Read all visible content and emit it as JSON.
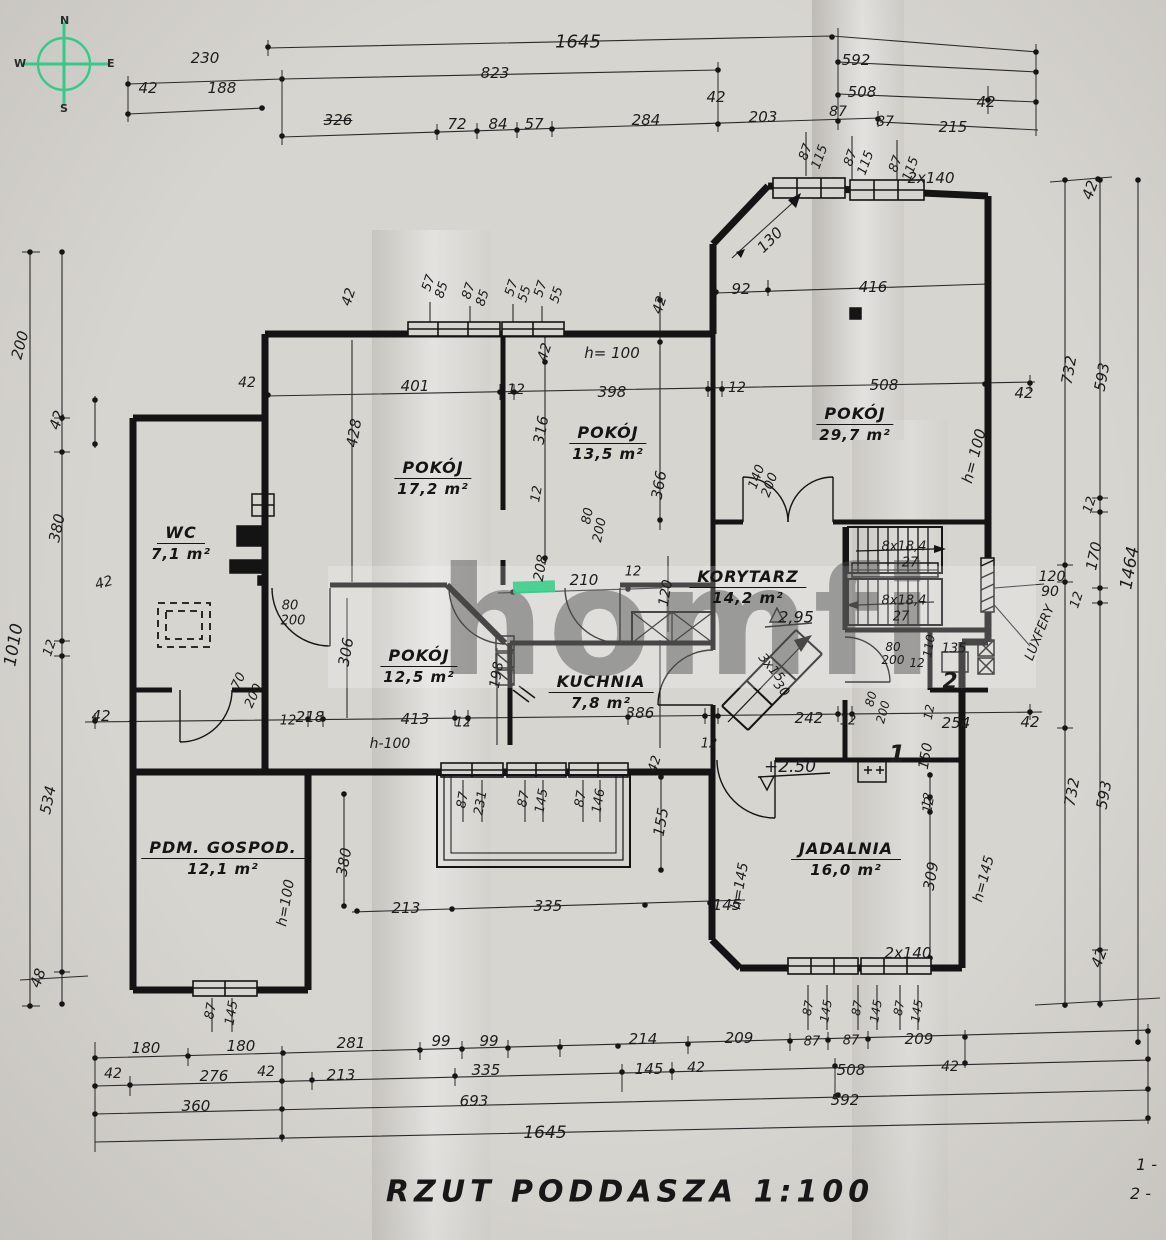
{
  "meta": {
    "title": "RZUT  PODDASZA  1:100"
  },
  "compass": {
    "n": "N",
    "e": "E",
    "s": "S",
    "w": "W"
  },
  "watermark": {
    "text": "homfi",
    "accent_color": "#3ecf8e"
  },
  "legend": {
    "items": [
      "1 -",
      "2 -"
    ]
  },
  "rooms": [
    {
      "name": "WC",
      "area": "7,1 m²",
      "x": 181,
      "y": 543
    },
    {
      "name": "POKÓJ",
      "area": "17,2 m²",
      "x": 433,
      "y": 478
    },
    {
      "name": "POKÓJ",
      "area": "13,5 m²",
      "x": 608,
      "y": 443
    },
    {
      "name": "POKÓJ",
      "area": "29,7 m²",
      "x": 855,
      "y": 424
    },
    {
      "name": "POKÓJ",
      "area": "12,5 m²",
      "x": 419,
      "y": 666
    },
    {
      "name": "KUCHNIA",
      "area": "7,8 m²",
      "x": 601,
      "y": 692
    },
    {
      "name": "KORYTARZ",
      "area": "14,2 m²",
      "x": 748,
      "y": 587
    },
    {
      "name": "PDM. GOSPOD.",
      "area": "12,1 m²",
      "x": 223,
      "y": 858
    },
    {
      "name": "JADALNIA",
      "area": "16,0 m²",
      "x": 846,
      "y": 859
    }
  ],
  "annotations": [
    {
      "t": "230",
      "x": 205,
      "y": 58
    },
    {
      "t": "42",
      "x": 148,
      "y": 88
    },
    {
      "t": "188",
      "x": 222,
      "y": 88
    },
    {
      "t": "326",
      "x": 338,
      "y": 120,
      "k": "strike"
    },
    {
      "t": "1645",
      "x": 578,
      "y": 42,
      "s": 18
    },
    {
      "t": "823",
      "x": 495,
      "y": 73
    },
    {
      "t": "42",
      "x": 716,
      "y": 97
    },
    {
      "t": "72",
      "x": 457,
      "y": 124
    },
    {
      "t": "84",
      "x": 498,
      "y": 124
    },
    {
      "t": "57",
      "x": 534,
      "y": 124
    },
    {
      "t": "284",
      "x": 646,
      "y": 120
    },
    {
      "t": "203",
      "x": 763,
      "y": 117
    },
    {
      "t": "592",
      "x": 856,
      "y": 60
    },
    {
      "t": "508",
      "x": 862,
      "y": 92
    },
    {
      "t": "42",
      "x": 986,
      "y": 102
    },
    {
      "t": "87",
      "x": 838,
      "y": 112,
      "s": 14
    },
    {
      "t": "87",
      "x": 885,
      "y": 122,
      "s": 14
    },
    {
      "t": "215",
      "x": 953,
      "y": 127
    },
    {
      "t": "42",
      "x": 1090,
      "y": 190,
      "r": -70
    },
    {
      "t": "87",
      "x": 806,
      "y": 152,
      "r": -70,
      "s": 13
    },
    {
      "t": "115",
      "x": 820,
      "y": 157,
      "r": -70,
      "s": 13
    },
    {
      "t": "87",
      "x": 851,
      "y": 158,
      "r": -70,
      "s": 13
    },
    {
      "t": "115",
      "x": 866,
      "y": 163,
      "r": -70,
      "s": 13
    },
    {
      "t": "87",
      "x": 896,
      "y": 164,
      "r": -70,
      "s": 13
    },
    {
      "t": "115",
      "x": 911,
      "y": 169,
      "r": -70,
      "s": 13
    },
    {
      "t": "2x140",
      "x": 931,
      "y": 178,
      "s": 15
    },
    {
      "t": "200",
      "x": 20,
      "y": 345,
      "r": -75
    },
    {
      "t": "42",
      "x": 57,
      "y": 420,
      "r": -72
    },
    {
      "t": "380",
      "x": 57,
      "y": 528,
      "r": -78
    },
    {
      "t": "1010",
      "x": 14,
      "y": 645,
      "r": -80,
      "s": 17
    },
    {
      "t": "12",
      "x": 50,
      "y": 648,
      "r": -72,
      "s": 13
    },
    {
      "t": "534",
      "x": 48,
      "y": 800,
      "r": -78
    },
    {
      "t": "48",
      "x": 38,
      "y": 978,
      "r": -70
    },
    {
      "t": "42",
      "x": 104,
      "y": 583,
      "r": -15,
      "s": 14
    },
    {
      "t": "42",
      "x": 101,
      "y": 716,
      "s": 15
    },
    {
      "t": "42",
      "x": 247,
      "y": 383,
      "s": 14
    },
    {
      "t": "42",
      "x": 349,
      "y": 297,
      "r": -72,
      "s": 14
    },
    {
      "t": "57",
      "x": 429,
      "y": 283,
      "r": -72,
      "s": 13
    },
    {
      "t": "85",
      "x": 442,
      "y": 290,
      "r": -72,
      "s": 13
    },
    {
      "t": "87",
      "x": 469,
      "y": 291,
      "r": -72,
      "s": 13
    },
    {
      "t": "85",
      "x": 483,
      "y": 298,
      "r": -72,
      "s": 13
    },
    {
      "t": "57",
      "x": 512,
      "y": 288,
      "r": -72,
      "s": 13
    },
    {
      "t": "55",
      "x": 525,
      "y": 294,
      "r": -72,
      "s": 13
    },
    {
      "t": "57",
      "x": 541,
      "y": 289,
      "r": -72,
      "s": 13
    },
    {
      "t": "55",
      "x": 557,
      "y": 295,
      "r": -72,
      "s": 13
    },
    {
      "t": "42",
      "x": 545,
      "y": 352,
      "r": -72,
      "s": 14
    },
    {
      "t": "401",
      "x": 415,
      "y": 386
    },
    {
      "t": "12",
      "x": 516,
      "y": 390,
      "s": 14
    },
    {
      "t": "398",
      "x": 612,
      "y": 392
    },
    {
      "t": "h= 100",
      "x": 612,
      "y": 353,
      "s": 15
    },
    {
      "t": "428",
      "x": 354,
      "y": 433,
      "r": -80
    },
    {
      "t": "316",
      "x": 541,
      "y": 430,
      "r": -80
    },
    {
      "t": "42",
      "x": 660,
      "y": 305,
      "r": -72,
      "s": 14
    },
    {
      "t": "12",
      "x": 737,
      "y": 388,
      "s": 14
    },
    {
      "t": "92",
      "x": 741,
      "y": 289
    },
    {
      "t": "130",
      "x": 770,
      "y": 240,
      "r": -45
    },
    {
      "t": "416",
      "x": 873,
      "y": 287
    },
    {
      "t": "508",
      "x": 884,
      "y": 385
    },
    {
      "t": "42",
      "x": 1024,
      "y": 393
    },
    {
      "t": "h= 100",
      "x": 974,
      "y": 456,
      "r": -75,
      "s": 15
    },
    {
      "t": "366",
      "x": 659,
      "y": 485,
      "r": -80
    },
    {
      "t": "12",
      "x": 537,
      "y": 494,
      "r": -80,
      "s": 13
    },
    {
      "t": "80",
      "x": 588,
      "y": 516,
      "r": -78,
      "s": 13
    },
    {
      "t": "200",
      "x": 600,
      "y": 530,
      "r": -78,
      "s": 13
    },
    {
      "t": "140",
      "x": 757,
      "y": 477,
      "r": -70,
      "s": 13
    },
    {
      "t": "200",
      "x": 770,
      "y": 485,
      "r": -70,
      "s": 13
    },
    {
      "t": "120",
      "x": 666,
      "y": 593,
      "r": -80,
      "s": 14
    },
    {
      "t": "210",
      "x": 584,
      "y": 580
    },
    {
      "t": "12",
      "x": 633,
      "y": 572,
      "s": 13
    },
    {
      "t": "208",
      "x": 541,
      "y": 568,
      "r": -80,
      "s": 14
    },
    {
      "t": "2,95",
      "x": 796,
      "y": 617,
      "s": 16,
      "n": "level-mark"
    },
    {
      "t": "8x18,4",
      "x": 904,
      "y": 547,
      "s": 13,
      "n": "stairs-label"
    },
    {
      "t": "27",
      "x": 910,
      "y": 563,
      "s": 13,
      "n": "stairs-label"
    },
    {
      "t": "8x18,4",
      "x": 904,
      "y": 601,
      "s": 13,
      "n": "stairs-label"
    },
    {
      "t": "27",
      "x": 901,
      "y": 617,
      "s": 13,
      "n": "stairs-label"
    },
    {
      "t": "3x15",
      "x": 771,
      "y": 668,
      "r": 50,
      "s": 13,
      "n": "stairs-label"
    },
    {
      "t": "30",
      "x": 781,
      "y": 689,
      "r": 50,
      "s": 13,
      "n": "stairs-label"
    },
    {
      "t": "80",
      "x": 290,
      "y": 606,
      "s": 13
    },
    {
      "t": "200",
      "x": 293,
      "y": 621,
      "s": 13
    },
    {
      "t": "70",
      "x": 239,
      "y": 681,
      "r": -65,
      "s": 13
    },
    {
      "t": "200",
      "x": 254,
      "y": 696,
      "r": -65,
      "s": 13
    },
    {
      "t": "306",
      "x": 346,
      "y": 652,
      "r": -80
    },
    {
      "t": "218",
      "x": 310,
      "y": 717
    },
    {
      "t": "12",
      "x": 288,
      "y": 721,
      "s": 13
    },
    {
      "t": "413",
      "x": 415,
      "y": 719
    },
    {
      "t": "h-100",
      "x": 390,
      "y": 744,
      "s": 14
    },
    {
      "t": "12",
      "x": 463,
      "y": 723,
      "s": 13
    },
    {
      "t": "198",
      "x": 497,
      "y": 675,
      "r": -80,
      "s": 14
    },
    {
      "t": "386",
      "x": 640,
      "y": 713
    },
    {
      "t": "12",
      "x": 709,
      "y": 744,
      "s": 13
    },
    {
      "t": "242",
      "x": 809,
      "y": 718
    },
    {
      "t": "12",
      "x": 848,
      "y": 721,
      "s": 13
    },
    {
      "t": "+2.50",
      "x": 790,
      "y": 767,
      "s": 17,
      "n": "level-mark"
    },
    {
      "t": "80",
      "x": 893,
      "y": 647,
      "s": 12
    },
    {
      "t": "200",
      "x": 893,
      "y": 660,
      "s": 12
    },
    {
      "t": "110",
      "x": 929,
      "y": 646,
      "r": -80,
      "s": 12
    },
    {
      "t": "12",
      "x": 917,
      "y": 663,
      "s": 12
    },
    {
      "t": "135",
      "x": 954,
      "y": 649,
      "s": 13
    },
    {
      "t": "80",
      "x": 871,
      "y": 699,
      "r": -75,
      "s": 12
    },
    {
      "t": "200",
      "x": 883,
      "y": 712,
      "r": -75,
      "s": 12
    },
    {
      "t": "2",
      "x": 950,
      "y": 682,
      "s": 22,
      "b": 1,
      "n": "room-number"
    },
    {
      "t": "1",
      "x": 897,
      "y": 754,
      "s": 24,
      "b": 1,
      "n": "room-number"
    },
    {
      "t": "12",
      "x": 929,
      "y": 712,
      "r": -80,
      "s": 12
    },
    {
      "t": "254",
      "x": 956,
      "y": 723,
      "s": 15
    },
    {
      "t": "150",
      "x": 926,
      "y": 756,
      "r": -80,
      "s": 14
    },
    {
      "t": "12",
      "x": 927,
      "y": 800,
      "r": -80,
      "s": 12
    },
    {
      "t": "42",
      "x": 1030,
      "y": 722,
      "s": 15
    },
    {
      "t": "732",
      "x": 1069,
      "y": 370,
      "r": -80
    },
    {
      "t": "593",
      "x": 1102,
      "y": 377,
      "r": -80
    },
    {
      "t": "12",
      "x": 1090,
      "y": 505,
      "r": -72,
      "s": 13
    },
    {
      "t": "170",
      "x": 1094,
      "y": 556,
      "r": -78
    },
    {
      "t": "1464",
      "x": 1130,
      "y": 568,
      "r": -80,
      "s": 17
    },
    {
      "t": "120",
      "x": 1052,
      "y": 577,
      "s": 14
    },
    {
      "t": "90",
      "x": 1050,
      "y": 592,
      "s": 14
    },
    {
      "t": "LUXFERY",
      "x": 1040,
      "y": 633,
      "r": -68,
      "s": 13,
      "n": "glass-blocks-label"
    },
    {
      "t": "12",
      "x": 1077,
      "y": 600,
      "r": -72,
      "s": 13
    },
    {
      "t": "732",
      "x": 1072,
      "y": 792,
      "r": -80
    },
    {
      "t": "593",
      "x": 1104,
      "y": 795,
      "r": -80
    },
    {
      "t": "42",
      "x": 1099,
      "y": 958,
      "r": -70
    },
    {
      "t": "87",
      "x": 463,
      "y": 800,
      "r": -80,
      "s": 13
    },
    {
      "t": "231",
      "x": 481,
      "y": 803,
      "r": -80,
      "s": 13
    },
    {
      "t": "87",
      "x": 524,
      "y": 799,
      "r": -80,
      "s": 13
    },
    {
      "t": "145",
      "x": 542,
      "y": 801,
      "r": -80,
      "s": 13
    },
    {
      "t": "87",
      "x": 581,
      "y": 799,
      "r": -80,
      "s": 13
    },
    {
      "t": "146",
      "x": 599,
      "y": 801,
      "r": -80,
      "s": 13
    },
    {
      "t": "42",
      "x": 655,
      "y": 764,
      "r": -72,
      "s": 13
    },
    {
      "t": "155",
      "x": 661,
      "y": 822,
      "r": -80
    },
    {
      "t": "145",
      "x": 727,
      "y": 905
    },
    {
      "t": "335",
      "x": 548,
      "y": 906
    },
    {
      "t": "213",
      "x": 406,
      "y": 908
    },
    {
      "t": "380",
      "x": 344,
      "y": 862,
      "r": -80
    },
    {
      "t": "h=100",
      "x": 286,
      "y": 903,
      "r": -80,
      "s": 14
    },
    {
      "t": "87",
      "x": 211,
      "y": 1011,
      "r": -80,
      "s": 13
    },
    {
      "t": "145",
      "x": 232,
      "y": 1013,
      "r": -80,
      "s": 13
    },
    {
      "t": "h=145",
      "x": 740,
      "y": 886,
      "r": -80,
      "s": 14
    },
    {
      "t": "h=145",
      "x": 984,
      "y": 879,
      "r": -75,
      "s": 14
    },
    {
      "t": "309",
      "x": 931,
      "y": 876,
      "r": -80
    },
    {
      "t": "12",
      "x": 929,
      "y": 805,
      "r": -80,
      "s": 13
    },
    {
      "t": "2x140",
      "x": 908,
      "y": 953,
      "s": 15
    },
    {
      "t": "87",
      "x": 808,
      "y": 1008,
      "r": -80,
      "s": 12
    },
    {
      "t": "145",
      "x": 826,
      "y": 1011,
      "r": -80,
      "s": 12
    },
    {
      "t": "87",
      "x": 857,
      "y": 1008,
      "r": -80,
      "s": 12
    },
    {
      "t": "145",
      "x": 876,
      "y": 1011,
      "r": -80,
      "s": 12
    },
    {
      "t": "87",
      "x": 899,
      "y": 1008,
      "r": -80,
      "s": 12
    },
    {
      "t": "145",
      "x": 917,
      "y": 1011,
      "r": -80,
      "s": 12
    },
    {
      "t": "180",
      "x": 146,
      "y": 1048
    },
    {
      "t": "180",
      "x": 241,
      "y": 1046
    },
    {
      "t": "281",
      "x": 351,
      "y": 1043
    },
    {
      "t": "99",
      "x": 441,
      "y": 1041
    },
    {
      "t": "99",
      "x": 489,
      "y": 1041
    },
    {
      "t": "214",
      "x": 643,
      "y": 1039
    },
    {
      "t": "209",
      "x": 739,
      "y": 1038
    },
    {
      "t": "87",
      "x": 812,
      "y": 1042,
      "s": 13
    },
    {
      "t": "87",
      "x": 851,
      "y": 1041,
      "s": 13
    },
    {
      "t": "209",
      "x": 919,
      "y": 1039
    },
    {
      "t": "42",
      "x": 113,
      "y": 1074,
      "s": 14
    },
    {
      "t": "276",
      "x": 214,
      "y": 1076
    },
    {
      "t": "42",
      "x": 266,
      "y": 1072,
      "s": 14
    },
    {
      "t": "213",
      "x": 341,
      "y": 1075
    },
    {
      "t": "335",
      "x": 486,
      "y": 1070
    },
    {
      "t": "145",
      "x": 649,
      "y": 1069
    },
    {
      "t": "42",
      "x": 696,
      "y": 1068,
      "s": 14
    },
    {
      "t": "508",
      "x": 851,
      "y": 1070
    },
    {
      "t": "42",
      "x": 950,
      "y": 1067,
      "s": 14
    },
    {
      "t": "360",
      "x": 196,
      "y": 1106
    },
    {
      "t": "693",
      "x": 474,
      "y": 1101
    },
    {
      "t": "592",
      "x": 845,
      "y": 1100
    },
    {
      "t": "1645",
      "x": 545,
      "y": 1133,
      "s": 17
    }
  ]
}
